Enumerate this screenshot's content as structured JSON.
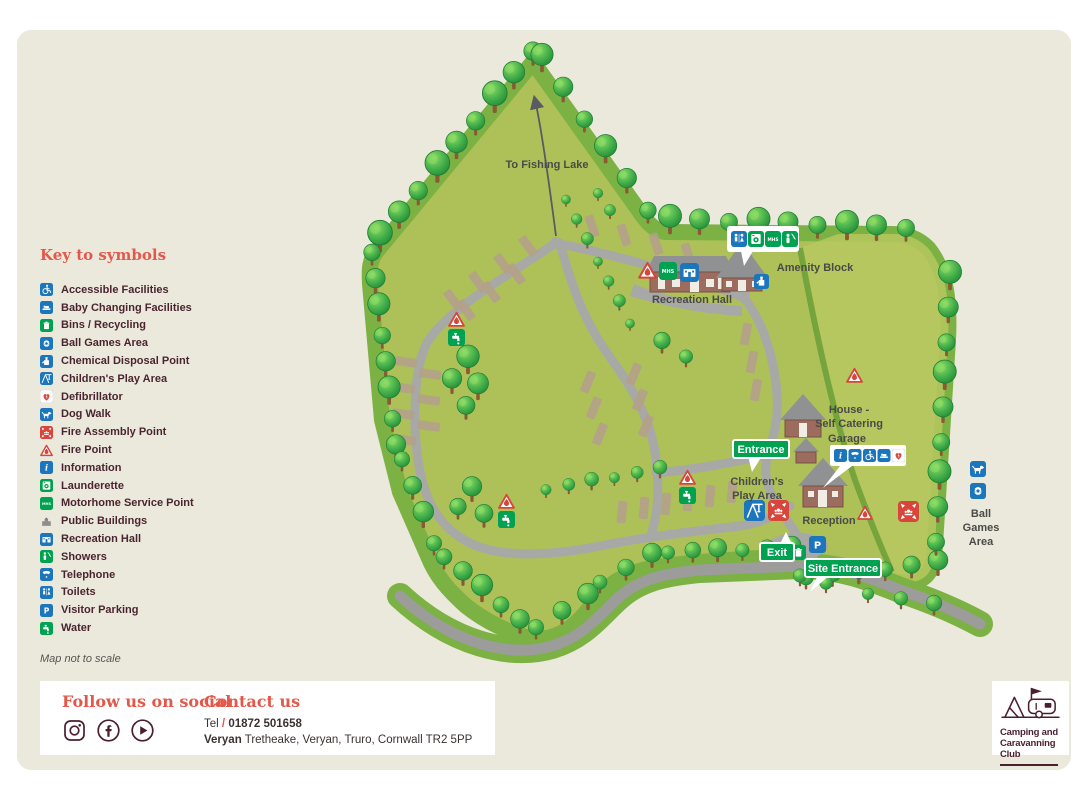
{
  "legend": {
    "title": "Key to symbols",
    "note": "Map not to scale",
    "items": [
      {
        "icon": "accessible",
        "label": "Accessible Facilities"
      },
      {
        "icon": "baby",
        "label": "Baby Changing Facilities"
      },
      {
        "icon": "bins",
        "label": "Bins / Recycling"
      },
      {
        "icon": "ballgames",
        "label": "Ball Games Area"
      },
      {
        "icon": "chemical",
        "label": "Chemical Disposal Point"
      },
      {
        "icon": "play",
        "label": "Children's Play Area"
      },
      {
        "icon": "defib",
        "label": "Defibrillator"
      },
      {
        "icon": "dogwalk",
        "label": "Dog Walk"
      },
      {
        "icon": "fireassembly",
        "label": "Fire Assembly Point"
      },
      {
        "icon": "firepoint",
        "label": "Fire Point"
      },
      {
        "icon": "info",
        "label": "Information"
      },
      {
        "icon": "launderette",
        "label": "Launderette"
      },
      {
        "icon": "mhs",
        "label": "Motorhome Service Point"
      },
      {
        "icon": "public",
        "label": "Public Buildings"
      },
      {
        "icon": "rechall",
        "label": "Recreation Hall"
      },
      {
        "icon": "showers",
        "label": "Showers"
      },
      {
        "icon": "telephone",
        "label": "Telephone"
      },
      {
        "icon": "toilets",
        "label": "Toilets"
      },
      {
        "icon": "parking",
        "label": "Visitor Parking"
      },
      {
        "icon": "water",
        "label": "Water"
      }
    ]
  },
  "map": {
    "labels": {
      "fishing_lake": "To Fishing Lake",
      "recreation_hall": "Recreation Hall",
      "amenity_block": "Amenity Block",
      "house_line1": "House -",
      "house_line2": "Self Catering",
      "garage": "Garage",
      "children_line1": "Children's",
      "children_line2": "Play Area",
      "reception": "Reception",
      "entrance": "Entrance",
      "exit": "Exit",
      "site_entrance": "Site Entrance",
      "ball_line1": "Ball",
      "ball_line2": "Games",
      "ball_line3": "Area"
    },
    "icons": [
      {
        "type": "toilets",
        "x": 731,
        "y": 231,
        "s": 16
      },
      {
        "type": "launderette",
        "x": 748,
        "y": 231,
        "s": 16
      },
      {
        "type": "mhs",
        "x": 765,
        "y": 231,
        "s": 16
      },
      {
        "type": "showers",
        "x": 782,
        "y": 231,
        "s": 16
      },
      {
        "type": "firepoint",
        "x": 638,
        "y": 261,
        "s": 19
      },
      {
        "type": "mhs",
        "x": 659,
        "y": 262,
        "s": 18
      },
      {
        "type": "rechall",
        "x": 680,
        "y": 263,
        "s": 19
      },
      {
        "type": "chemical",
        "x": 754,
        "y": 274,
        "s": 15
      },
      {
        "type": "firepoint",
        "x": 846,
        "y": 367,
        "s": 17
      },
      {
        "type": "firepoint",
        "x": 448,
        "y": 311,
        "s": 17
      },
      {
        "type": "water",
        "x": 448,
        "y": 329,
        "s": 17
      },
      {
        "type": "firepoint",
        "x": 498,
        "y": 493,
        "s": 17
      },
      {
        "type": "water",
        "x": 498,
        "y": 511,
        "s": 17
      },
      {
        "type": "firepoint",
        "x": 679,
        "y": 469,
        "s": 17
      },
      {
        "type": "water",
        "x": 679,
        "y": 487,
        "s": 17
      },
      {
        "type": "info",
        "x": 834,
        "y": 449,
        "s": 13
      },
      {
        "type": "telephone",
        "x": 848.5,
        "y": 449,
        "s": 13
      },
      {
        "type": "accessible",
        "x": 863,
        "y": 449,
        "s": 13
      },
      {
        "type": "baby",
        "x": 877.5,
        "y": 449,
        "s": 13
      },
      {
        "type": "defib",
        "x": 892,
        "y": 449,
        "s": 13
      },
      {
        "type": "play",
        "x": 744,
        "y": 500,
        "s": 21
      },
      {
        "type": "fireassembly",
        "x": 768,
        "y": 500,
        "s": 21
      },
      {
        "type": "firepoint",
        "x": 857,
        "y": 505,
        "s": 16
      },
      {
        "type": "fireassembly",
        "x": 898,
        "y": 501,
        "s": 21
      },
      {
        "type": "bins",
        "x": 791,
        "y": 545,
        "s": 15
      },
      {
        "type": "parking",
        "x": 809,
        "y": 536,
        "s": 17
      },
      {
        "type": "dogwalk",
        "x": 970,
        "y": 461,
        "s": 16
      },
      {
        "type": "ballgames",
        "x": 970,
        "y": 483,
        "s": 16
      }
    ]
  },
  "footer": {
    "social_title": "Follow us on social",
    "contact_title": "Contact us",
    "tel_label": "Tel",
    "tel_sep": "/",
    "tel_number": "01872 501658",
    "site_name": "Veryan",
    "address": "Tretheake, Veryan, Truro, Cornwall TR2 5PP"
  },
  "logo": {
    "line1": "Camping and",
    "line2": "Caravanning",
    "line3": "Club"
  },
  "colors": {
    "accent_red": "#e4584c",
    "sign_green": "#00a151",
    "icon_blue": "#1c76bc",
    "icon_green": "#00a150",
    "icon_red": "#d8453a",
    "legend_text": "#4a2531",
    "background": "#ebe9dc"
  }
}
